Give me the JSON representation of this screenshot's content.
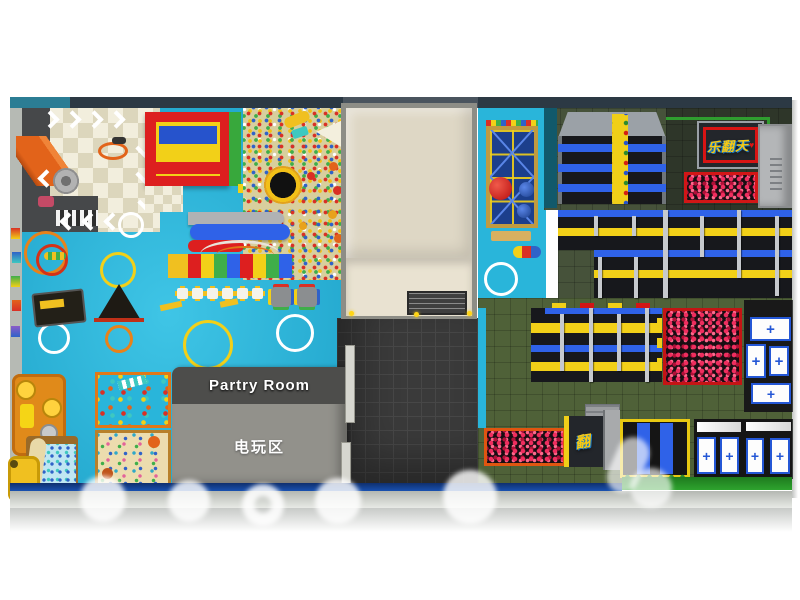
{
  "scene": {
    "description": "Top-view 3D render of an indoor playground (left) and trampoline park (right) floor plan"
  },
  "party_room": {
    "title": "Partry Room",
    "subtitle": "电玩区"
  },
  "branding": {
    "logo": "乐翻天",
    "logo_mini": "翻",
    "heart": "♥"
  },
  "icons": {
    "plus": "+"
  },
  "colors": {
    "kids_floor_blue": "#29b5da",
    "ball_pit_tan": "#d8cf9d",
    "trampoline_bed": "#17181c",
    "pad_blue": "#2f62e8",
    "pad_yellow": "#f2d018",
    "foam_pit_pink": "#e8285a",
    "turf_green": "#4b5c36",
    "roof_beige": "#ded7c5",
    "frame_red": "#d81414",
    "wall_bottom_blue": "#1a55b8",
    "wall_bottom_green": "#2ea32e"
  }
}
